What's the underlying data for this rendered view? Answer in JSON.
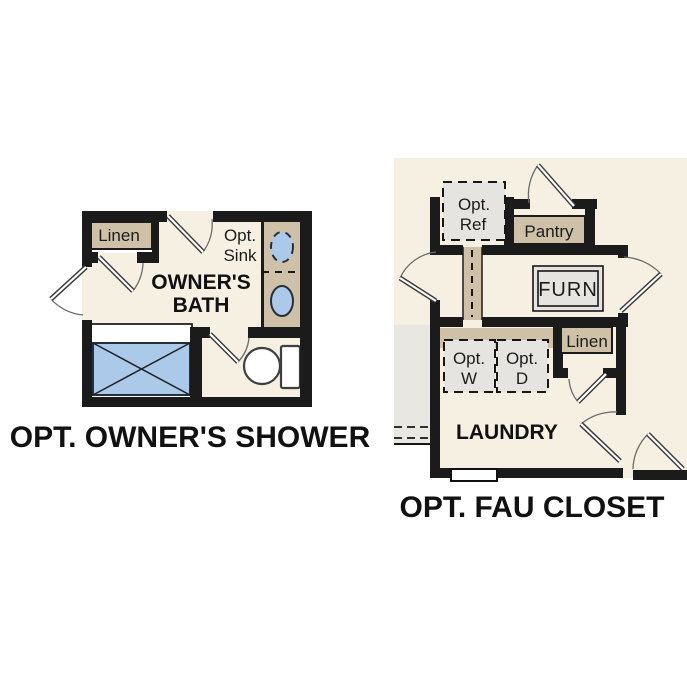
{
  "page": {
    "background": "#ffffff",
    "kind": "floor-plan-options-graphic"
  },
  "colors": {
    "floor": "#f6f0e2",
    "wall": "#1b1b1b",
    "cabinet_tan": "#cec1a7",
    "fixture_gray": "#e5e4e1",
    "water_blue": "#abc9e8",
    "stair_gray": "#e9e7e2",
    "door_arc": "#6b6b6b",
    "text": "#111111",
    "background": "#ffffff"
  },
  "left_plan": {
    "title": "OPT. OWNER'S SHOWER",
    "room_line1": "OWNER'S",
    "room_line2": "BATH",
    "linen_label": "Linen",
    "opt_sink_line1": "Opt.",
    "opt_sink_line2": "Sink",
    "fixtures": [
      "shower-pan-icon",
      "toilet-icon",
      "sink-icon",
      "optional-sink-icon",
      "door-swing-icon"
    ]
  },
  "right_plan": {
    "title": "OPT. FAU CLOSET",
    "room_label": "LAUNDRY",
    "opt_ref_line1": "Opt.",
    "opt_ref_line2": "Ref",
    "pantry_label": "Pantry",
    "furn_label": "FURN",
    "linen_label": "Linen",
    "opt_w_line1": "Opt.",
    "opt_w_line2": "W",
    "opt_d_line1": "Opt.",
    "opt_d_line2": "D",
    "fixtures": [
      "optional-refrigerator-icon",
      "washer-icon",
      "dryer-icon",
      "furnace-icon",
      "window-icon",
      "stairs-icon",
      "door-swing-icon"
    ]
  }
}
